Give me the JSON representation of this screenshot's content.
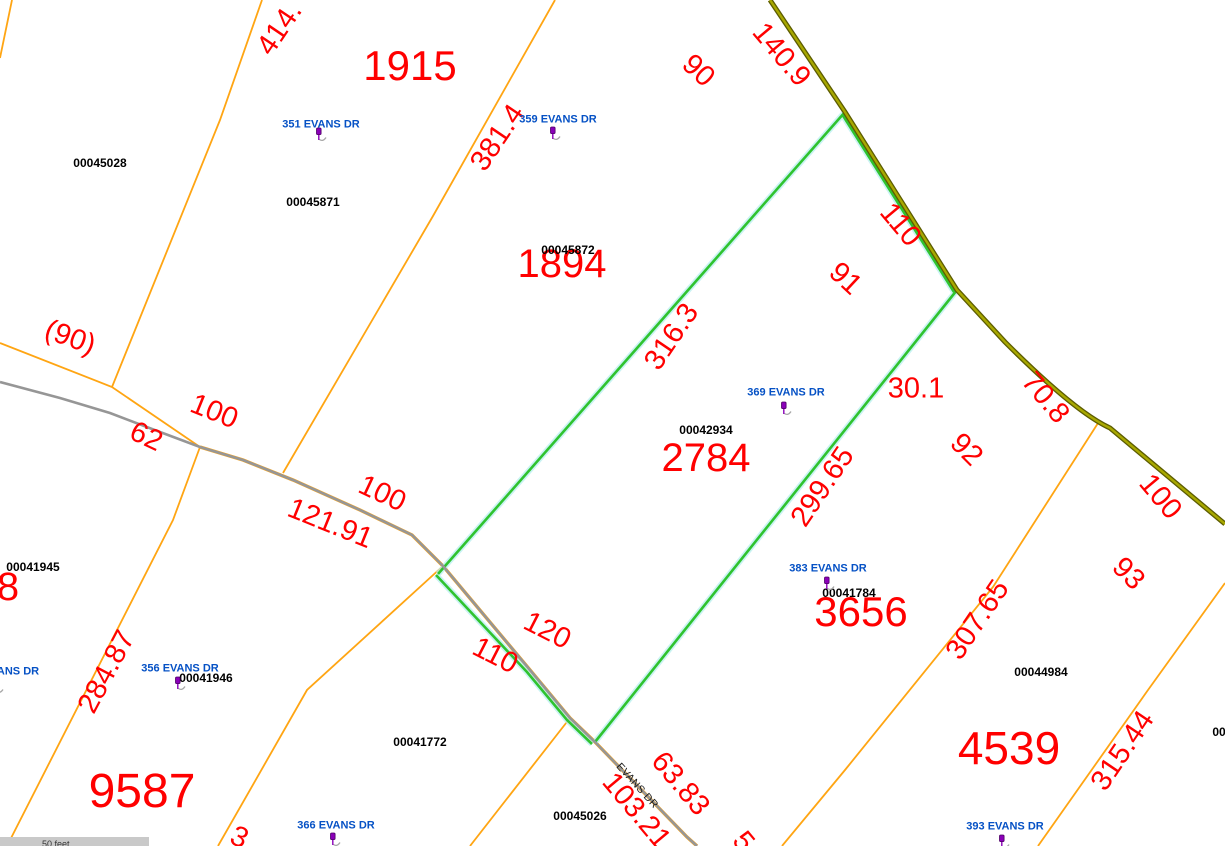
{
  "map": {
    "scalebar_label": "50 feet",
    "colors": {
      "dimension_text": "#ff0000",
      "lot_number_text": "#ff0000",
      "parcel_id_text": "#000000",
      "address_text": "#0551c5",
      "parcel_line": "#ffa513",
      "highlight_line": "#2fc32f",
      "highlight_halo": "#b9efef",
      "road_gray": "#969696",
      "road_olive_core": "#a8a800",
      "road_olive_edge": "#5c5c00",
      "pin_purple": "#8a00b8"
    },
    "labels": [
      {
        "type": "dim",
        "t": "414.",
        "x": 280,
        "y": 29,
        "rot": -56
      },
      {
        "type": "dim",
        "t": "381.4",
        "x": 498,
        "y": 138,
        "rot": -56
      },
      {
        "type": "dim",
        "t": "140.9",
        "x": 781,
        "y": 55,
        "rot": 50
      },
      {
        "type": "dim",
        "t": "90",
        "x": 698,
        "y": 71,
        "rot": 43
      },
      {
        "type": "dim",
        "t": "110",
        "x": 900,
        "y": 225,
        "rot": 50
      },
      {
        "type": "dim",
        "t": "91",
        "x": 845,
        "y": 279,
        "rot": 43
      },
      {
        "type": "dim",
        "t": "316.3",
        "x": 672,
        "y": 337,
        "rot": -56
      },
      {
        "type": "dim",
        "t": "30.1",
        "x": 916,
        "y": 389,
        "rot": 0
      },
      {
        "type": "dim",
        "t": "299.65",
        "x": 823,
        "y": 487,
        "rot": -56
      },
      {
        "type": "dim",
        "t": "92",
        "x": 966,
        "y": 450,
        "rot": 45
      },
      {
        "type": "dim",
        "t": "70.8",
        "x": 1045,
        "y": 398,
        "rot": 50
      },
      {
        "type": "dim",
        "t": "100",
        "x": 1160,
        "y": 497,
        "rot": 50
      },
      {
        "type": "dim",
        "t": "(90)",
        "x": 70,
        "y": 338,
        "rot": 20
      },
      {
        "type": "dim",
        "t": "100",
        "x": 214,
        "y": 412,
        "rot": 22
      },
      {
        "type": "dim",
        "t": "62",
        "x": 146,
        "y": 437,
        "rot": 25
      },
      {
        "type": "dim",
        "t": "100",
        "x": 382,
        "y": 494,
        "rot": 25
      },
      {
        "type": "dim",
        "t": "121.91",
        "x": 330,
        "y": 524,
        "rot": 22
      },
      {
        "type": "dim",
        "t": "120",
        "x": 547,
        "y": 631,
        "rot": 27
      },
      {
        "type": "dim",
        "t": "110",
        "x": 495,
        "y": 656,
        "rot": 27
      },
      {
        "type": "dim",
        "t": "284.87",
        "x": 107,
        "y": 672,
        "rot": -62
      },
      {
        "type": "dim",
        "t": "307.65",
        "x": 978,
        "y": 620,
        "rot": -56
      },
      {
        "type": "dim",
        "t": "93",
        "x": 1128,
        "y": 574,
        "rot": 45
      },
      {
        "type": "dim",
        "t": "315.44",
        "x": 1123,
        "y": 751,
        "rot": -56
      },
      {
        "type": "dim",
        "t": "63.83",
        "x": 680,
        "y": 784,
        "rot": 50
      },
      {
        "type": "dim",
        "t": "103.21",
        "x": 636,
        "y": 811,
        "rot": 50
      },
      {
        "type": "dim",
        "t": "3",
        "x": 239,
        "y": 838,
        "rot": 25
      },
      {
        "type": "dim",
        "t": "5",
        "x": 743,
        "y": 842,
        "rot": 50
      },
      {
        "type": "lot",
        "t": "1915",
        "x": 410,
        "y": 66,
        "fs": 42
      },
      {
        "type": "lot",
        "t": "1894",
        "x": 562,
        "y": 264,
        "fs": 40
      },
      {
        "type": "lot",
        "t": "2784",
        "x": 706,
        "y": 458,
        "fs": 40
      },
      {
        "type": "lot",
        "t": "3656",
        "x": 861,
        "y": 612,
        "fs": 42
      },
      {
        "type": "lot",
        "t": "4539",
        "x": 1009,
        "y": 748,
        "fs": 46
      },
      {
        "type": "lot",
        "t": "9587",
        "x": 142,
        "y": 792,
        "fs": 48
      },
      {
        "type": "lot",
        "t": "8",
        "x": 8,
        "y": 587,
        "fs": 40
      },
      {
        "type": "pid",
        "t": "00045028",
        "x": 100,
        "y": 163
      },
      {
        "type": "pid",
        "t": "00045871",
        "x": 313,
        "y": 202
      },
      {
        "type": "pid",
        "t": "00045872",
        "x": 568,
        "y": 250
      },
      {
        "type": "pid",
        "t": "00042934",
        "x": 706,
        "y": 430
      },
      {
        "type": "pid",
        "t": "00041784",
        "x": 849,
        "y": 593
      },
      {
        "type": "pid",
        "t": "00041945",
        "x": 33,
        "y": 567
      },
      {
        "type": "pid",
        "t": "00041946",
        "x": 206,
        "y": 678
      },
      {
        "type": "pid",
        "t": "00041772",
        "x": 420,
        "y": 742
      },
      {
        "type": "pid",
        "t": "00045026",
        "x": 580,
        "y": 816
      },
      {
        "type": "pid",
        "t": "00044984",
        "x": 1041,
        "y": 672
      },
      {
        "type": "pid",
        "t": "00",
        "x": 1219,
        "y": 732
      },
      {
        "type": "addr",
        "t": "351 EVANS DR",
        "x": 321,
        "y": 125,
        "pin": {
          "x": 311,
          "y": 127
        }
      },
      {
        "type": "addr",
        "t": "359 EVANS DR",
        "x": 558,
        "y": 120,
        "pin": {
          "x": 545,
          "y": 126
        }
      },
      {
        "type": "addr",
        "t": "369 EVANS DR",
        "x": 786,
        "y": 393,
        "pin": {
          "x": 776,
          "y": 401
        }
      },
      {
        "type": "addr",
        "t": "383 EVANS DR",
        "x": 828,
        "y": 569,
        "pin": {
          "x": 819,
          "y": 576
        }
      },
      {
        "type": "addr",
        "t": "356 EVANS DR",
        "x": 180,
        "y": 669,
        "pin": {
          "x": 170,
          "y": 676
        }
      },
      {
        "type": "addr",
        "t": "366 EVANS DR",
        "x": 336,
        "y": 826,
        "pin": {
          "x": 325,
          "y": 832
        }
      },
      {
        "type": "addr",
        "t": "393 EVANS DR",
        "x": 1005,
        "y": 827,
        "pin": {
          "x": 994,
          "y": 834
        }
      },
      {
        "type": "addr",
        "t": "ANS DR",
        "x": 18,
        "y": 672,
        "pin": {
          "x": -12,
          "y": 679
        }
      },
      {
        "type": "road",
        "t": "EVANS DR",
        "x": 637,
        "y": 786,
        "rot": 48
      }
    ]
  }
}
